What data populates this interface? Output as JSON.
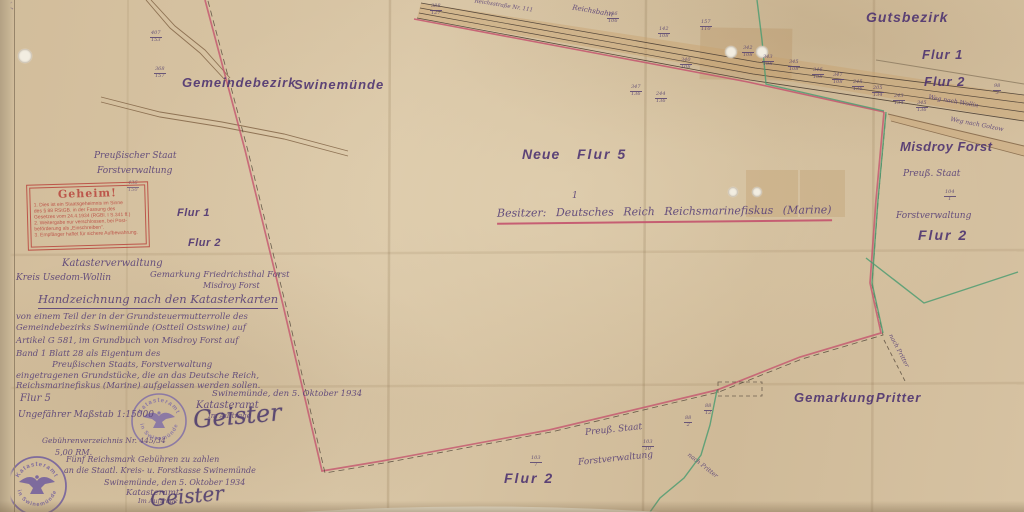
{
  "map": {
    "region_labels": [
      {
        "text": "Gemeindebezirk",
        "x": 182,
        "y": 76,
        "size": 13,
        "ls": 1
      },
      {
        "text": "Swinemünde",
        "x": 294,
        "y": 78,
        "size": 13,
        "ls": 1
      },
      {
        "text": "Gutsbezirk",
        "x": 866,
        "y": 10,
        "size": 14,
        "ls": 1
      },
      {
        "text": "Flur 1",
        "x": 922,
        "y": 48,
        "size": 13,
        "ls": 1
      },
      {
        "text": "Flur 2",
        "x": 924,
        "y": 75,
        "size": 13,
        "ls": 1
      },
      {
        "text": "Misdroy Forst",
        "x": 900,
        "y": 140,
        "size": 13,
        "ls": 0.5
      },
      {
        "text": "Flur 2",
        "x": 918,
        "y": 228,
        "size": 14,
        "ls": 2
      },
      {
        "text": "Neue",
        "x": 522,
        "y": 147,
        "size": 14,
        "ls": 1
      },
      {
        "text": "Flur 5",
        "x": 577,
        "y": 147,
        "size": 14,
        "ls": 2
      },
      {
        "text": "Flur 1",
        "x": 177,
        "y": 208,
        "size": 11,
        "ls": 0.5
      },
      {
        "text": "Flur 2",
        "x": 188,
        "y": 238,
        "size": 11,
        "ls": 0.5
      },
      {
        "text": "Gemarkung",
        "x": 794,
        "y": 391,
        "size": 13,
        "ls": 1
      },
      {
        "text": "Pritter",
        "x": 876,
        "y": 391,
        "size": 13,
        "ls": 1
      },
      {
        "text": "Flur 2",
        "x": 504,
        "y": 471,
        "size": 14,
        "ls": 2
      }
    ],
    "hand_labels": [
      {
        "text": "Preußischer Staat",
        "x": 94,
        "y": 152,
        "size": 9
      },
      {
        "text": "Forstverwaltung",
        "x": 97,
        "y": 167,
        "size": 9
      },
      {
        "text": "Preuß. Staat",
        "x": 903,
        "y": 170,
        "size": 9
      },
      {
        "text": "Forstverwaltung",
        "x": 896,
        "y": 212,
        "size": 9
      },
      {
        "text": "Preuß. Staat",
        "x": 585,
        "y": 426,
        "size": 9,
        "rot": -6
      },
      {
        "text": "Forstverwaltung",
        "x": 578,
        "y": 455,
        "size": 9,
        "rot": -6
      },
      {
        "text": "nach Pritter",
        "x": 880,
        "y": 348,
        "size": 6,
        "rot": 62
      },
      {
        "text": "nach Pritter",
        "x": 684,
        "y": 463,
        "size": 6,
        "rot": 38
      },
      {
        "text": "Weg nach Wollin",
        "x": 928,
        "y": 99,
        "size": 6,
        "rot": 10
      },
      {
        "text": "Weg nach Golzow",
        "x": 950,
        "y": 122,
        "size": 6,
        "rot": 11
      },
      {
        "text": "Reichsbahn",
        "x": 572,
        "y": 8,
        "size": 7,
        "rot": 10
      },
      {
        "text": "Reichsstraße Nr. 111",
        "x": 474,
        "y": 4,
        "size": 5.5,
        "rot": 9
      },
      {
        "text": "1",
        "x": 572,
        "y": 192,
        "size": 9
      }
    ],
    "owner_line": {
      "text": "Besitzer:  Deutsches Reich   Reichsmarinefiskus  (Marine)"
    },
    "fractions": [
      {
        "top": "388",
        "bottom": "127",
        "x": 430,
        "y": 4
      },
      {
        "top": "186",
        "bottom": "106",
        "x": 607,
        "y": 12
      },
      {
        "top": "142",
        "bottom": "108",
        "x": 658,
        "y": 27
      },
      {
        "top": "157",
        "bottom": "110",
        "x": 700,
        "y": 20
      },
      {
        "top": "340",
        "bottom": "108",
        "x": 680,
        "y": 58
      },
      {
        "top": "342",
        "bottom": "108",
        "x": 742,
        "y": 46
      },
      {
        "top": "343",
        "bottom": "108",
        "x": 762,
        "y": 55
      },
      {
        "top": "345",
        "bottom": "108",
        "x": 788,
        "y": 60
      },
      {
        "top": "346",
        "bottom": "108",
        "x": 812,
        "y": 68
      },
      {
        "top": "347",
        "bottom": "108",
        "x": 832,
        "y": 73
      },
      {
        "top": "245",
        "bottom": "136",
        "x": 852,
        "y": 80
      },
      {
        "top": "205",
        "bottom": "134",
        "x": 872,
        "y": 86
      },
      {
        "top": "243",
        "bottom": "134",
        "x": 893,
        "y": 94
      },
      {
        "top": "345",
        "bottom": "136",
        "x": 916,
        "y": 101
      },
      {
        "top": "98",
        "bottom": "3",
        "x": 993,
        "y": 84
      },
      {
        "top": "347",
        "bottom": "136",
        "x": 630,
        "y": 85
      },
      {
        "top": "244",
        "bottom": "136",
        "x": 655,
        "y": 92
      },
      {
        "top": "407",
        "bottom": "153",
        "x": 150,
        "y": 31
      },
      {
        "top": "368",
        "bottom": "157",
        "x": 154,
        "y": 67
      },
      {
        "top": "436",
        "bottom": "150",
        "x": 127,
        "y": 181
      },
      {
        "top": "104",
        "bottom": "1",
        "x": 944,
        "y": 190
      },
      {
        "top": "88",
        "bottom": "12",
        "x": 704,
        "y": 404
      },
      {
        "top": "88",
        "bottom": "2",
        "x": 684,
        "y": 416
      },
      {
        "top": "103",
        "bottom": "10",
        "x": 642,
        "y": 440
      },
      {
        "top": "103",
        "bottom": "7",
        "x": 530,
        "y": 456
      }
    ],
    "signatures": [
      {
        "text": "Geister",
        "x": 193,
        "y": 404,
        "size": 24,
        "rot": -5
      },
      {
        "text": "Geister",
        "x": 150,
        "y": 486,
        "size": 20,
        "rot": -5
      }
    ]
  },
  "document": {
    "lines": [
      {
        "text": "Katasterverwaltung",
        "x": 62,
        "y": 259,
        "size": 10
      },
      {
        "text": "Kreis Usedom-Wollin",
        "x": 16,
        "y": 274,
        "size": 9
      },
      {
        "text": "Gemarkung Friedrichsthal Forst",
        "x": 150,
        "y": 271,
        "size": 8.5
      },
      {
        "text": "Misdroy Forst",
        "x": 203,
        "y": 282,
        "size": 8
      },
      {
        "text": "Handzeichnung nach den Katasterkarten",
        "x": 38,
        "y": 294,
        "size": 11.5,
        "u": 1
      },
      {
        "text": "von einem Teil der in der Grundsteuermutterrolle des",
        "x": 16,
        "y": 313,
        "size": 8.5
      },
      {
        "text": "Gemeindebezirks Swinemünde (Ostteil Ostswine) auf",
        "x": 16,
        "y": 324,
        "size": 8.5
      },
      {
        "text": "Artikel G 581, im Grundbuch von Misdroy Forst auf",
        "x": 16,
        "y": 337,
        "size": 8.5
      },
      {
        "text": "Band 1 Blatt 28 als Eigentum des",
        "x": 16,
        "y": 350,
        "size": 8.5
      },
      {
        "text": "Preußischen Staats, Forstverwaltung",
        "x": 52,
        "y": 361,
        "size": 8.5
      },
      {
        "text": "eingetragenen Grundstücke, die an das Deutsche Reich,",
        "x": 16,
        "y": 372,
        "size": 8.5
      },
      {
        "text": "Reichsmarinefiskus (Marine) aufgelassen werden sollen.",
        "x": 16,
        "y": 382,
        "size": 8.5
      },
      {
        "text": "Swinemünde, den 5. Oktober 1934",
        "x": 212,
        "y": 390,
        "size": 8.5
      },
      {
        "text": "Katasteramt",
        "x": 196,
        "y": 401,
        "size": 10
      },
      {
        "text": "Im Auftrage",
        "x": 208,
        "y": 413,
        "size": 7
      },
      {
        "text": "Flur 5",
        "x": 20,
        "y": 394,
        "size": 10
      },
      {
        "text": "Ungefährer Maßstab 1:15000",
        "x": 18,
        "y": 411,
        "size": 9
      },
      {
        "text": "Gebührenverzeichnis Nr. 445/34",
        "x": 42,
        "y": 437,
        "size": 7.5
      },
      {
        "text": "5,00 RM.",
        "x": 55,
        "y": 449,
        "size": 8
      },
      {
        "text": "Fünf Reichsmark Gebühren zu zahlen",
        "x": 66,
        "y": 456,
        "size": 8
      },
      {
        "text": "an die Staatl. Kreis- u. Forstkasse Swinemünde",
        "x": 64,
        "y": 467,
        "size": 8
      },
      {
        "text": "Swinemünde, den 5. Oktober 1934",
        "x": 104,
        "y": 479,
        "size": 8
      },
      {
        "text": "Katasteramt",
        "x": 126,
        "y": 489,
        "size": 8.5
      },
      {
        "text": "Im Auftrage",
        "x": 138,
        "y": 498,
        "size": 6.5
      }
    ]
  },
  "geheim_stamp": {
    "title": "Geheim!",
    "lines": [
      "1. Dies ist ein Staatsgeheimnis im Sinne",
      "   des § 88 RStGB. in der Fassung des",
      "   Gesetzes vom 24.4.1934 (RGBl. I S.341 ff.)",
      "2. Weitergabe nur verschlossen, bei Post-",
      "   beförderung als „Einschreiben“.",
      "3. Empfänger haftet für sichere Aufbewahrung."
    ]
  },
  "round_stamp": {
    "top": "Katasteramt",
    "bottom": "in Swinemünde"
  },
  "colors": {
    "paper": "#d6c2a0",
    "ink": "#5c4579",
    "label_purple": "#4a3070",
    "boundary_red": "#c4556e",
    "boundary_green": "#4f9c72",
    "road_brown": "#7d5f41",
    "stamp_purple": "#7a68a8",
    "geheim_red": "#b8443c"
  }
}
